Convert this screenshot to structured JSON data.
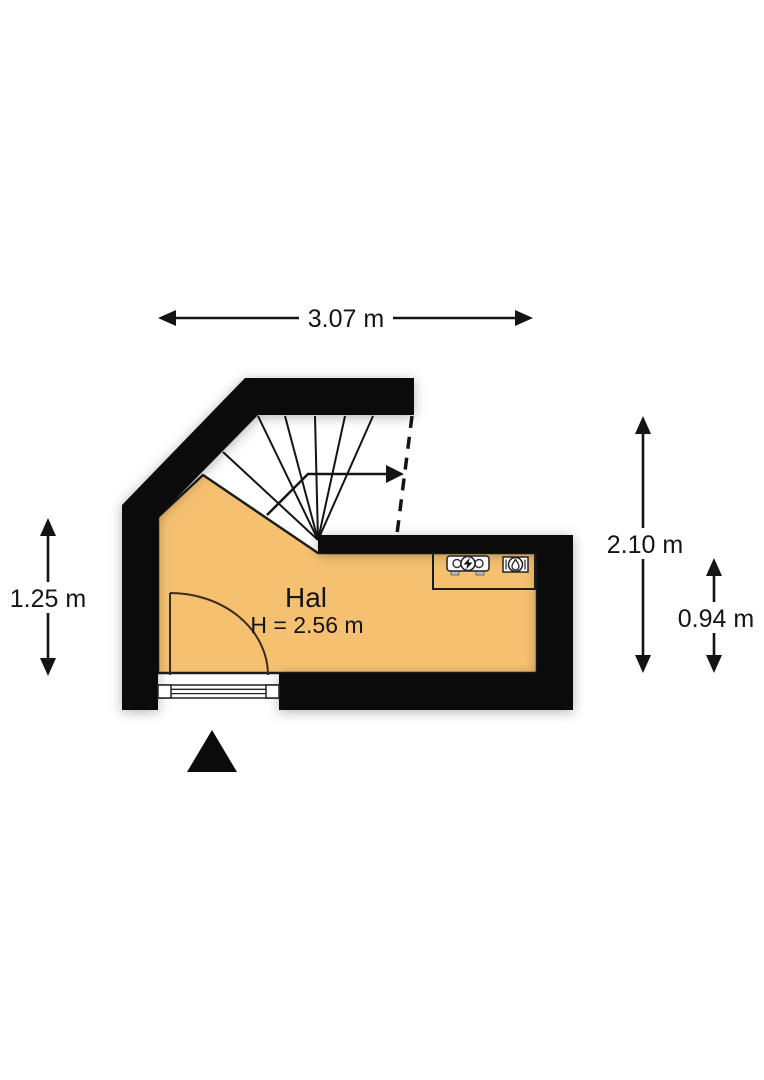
{
  "floorplan": {
    "room": {
      "name": "Hal",
      "height_label": "H = 2.56 m"
    },
    "dimensions": {
      "top_width": "3.07 m",
      "right_total_height": "2.10 m",
      "right_lower_height": "0.94 m",
      "left_height": "1.25 m"
    },
    "colors": {
      "wall": "#0b0b0b",
      "floor_fill": "#f5c171",
      "line": "#1c1c1c",
      "door_arc": "#3b2b1b",
      "background": "#ffffff"
    },
    "icons": {
      "electric_meter": "electric-meter-icon",
      "water_meter": "water-meter-icon",
      "stairs_direction_arrow": "stairs-direction-arrow-icon",
      "entrance_marker": "entrance-marker-icon"
    }
  }
}
